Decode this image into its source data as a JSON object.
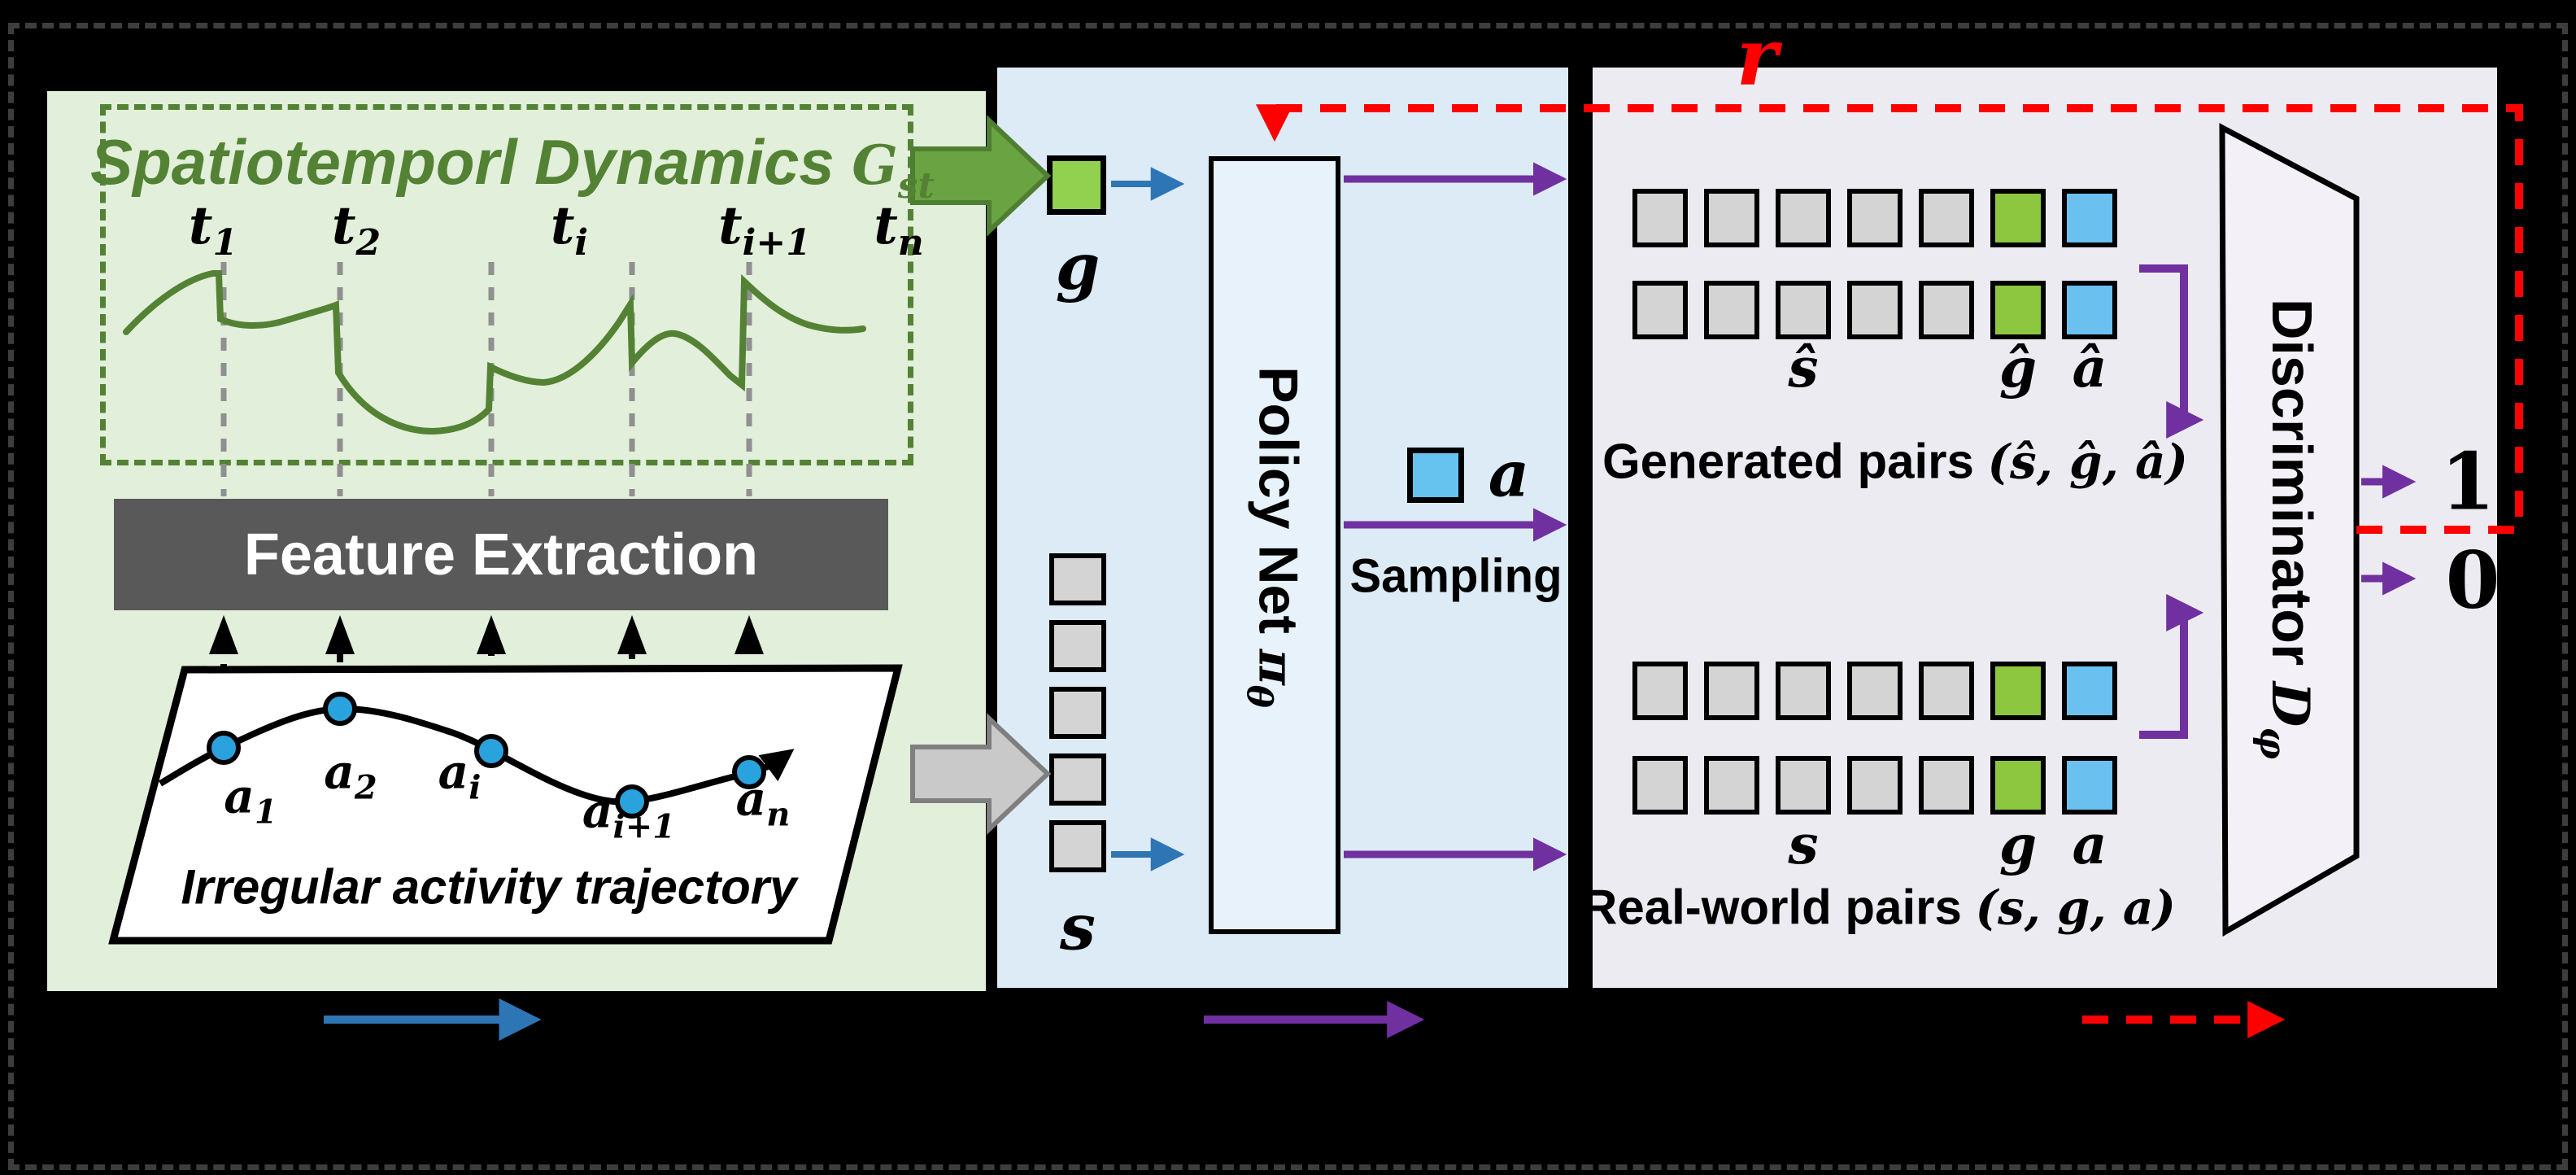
{
  "dynamics_panel": {
    "title": "Spatiotemporl Dynamics",
    "title_symbol": "G",
    "title_symbol_sub": "st",
    "time_labels": [
      {
        "base": "t",
        "sub": "1"
      },
      {
        "base": "t",
        "sub": "2"
      },
      {
        "base": "t",
        "sub": "i"
      },
      {
        "base": "t",
        "sub": "i+1"
      },
      {
        "base": "t",
        "sub": "n"
      }
    ],
    "feature_extraction": "Feature Extraction",
    "trajectory_points": [
      {
        "base": "a",
        "sub": "1"
      },
      {
        "base": "a",
        "sub": "2"
      },
      {
        "base": "a",
        "sub": "i"
      },
      {
        "base": "a",
        "sub": "i+1"
      },
      {
        "base": "a",
        "sub": "n"
      }
    ],
    "trajectory_caption": "Irregular activity trajectory"
  },
  "policy_panel": {
    "goal_label": "g",
    "state_label": "s",
    "action_label": "a",
    "policy_net": "Policy Net",
    "policy_symbol": "π",
    "policy_symbol_sub": "θ",
    "sampling": "Sampling"
  },
  "discriminator_panel": {
    "reward_label": "r",
    "generated_cell_labels": [
      "ŝ",
      "ĝ",
      "â"
    ],
    "generated_caption": "Generated pairs",
    "generated_tuple": "(ŝ, ĝ, â)",
    "real_cell_labels": [
      "s",
      "g",
      "a"
    ],
    "real_caption": "Real-world pairs",
    "real_tuple": "(s, g, a)",
    "discriminator": "Discriminator",
    "discriminator_symbol": "D",
    "discriminator_symbol_sub": "φ",
    "output_top": "1",
    "output_bottom": "0"
  },
  "colors": {
    "panel_green_bg": "#e2efda",
    "panel_blue_bg": "#dcebf5",
    "panel_purple_bg": "#edebf2",
    "accent_green": "#548235",
    "cell_green": "#92d050",
    "cell_blue": "#6ac1f0",
    "cell_gray": "#d4d4d4",
    "bar_gray": "#595959",
    "arrow_blue": "#2e75b6",
    "arrow_purple": "#7030a0",
    "arrow_red": "#ff0000"
  }
}
